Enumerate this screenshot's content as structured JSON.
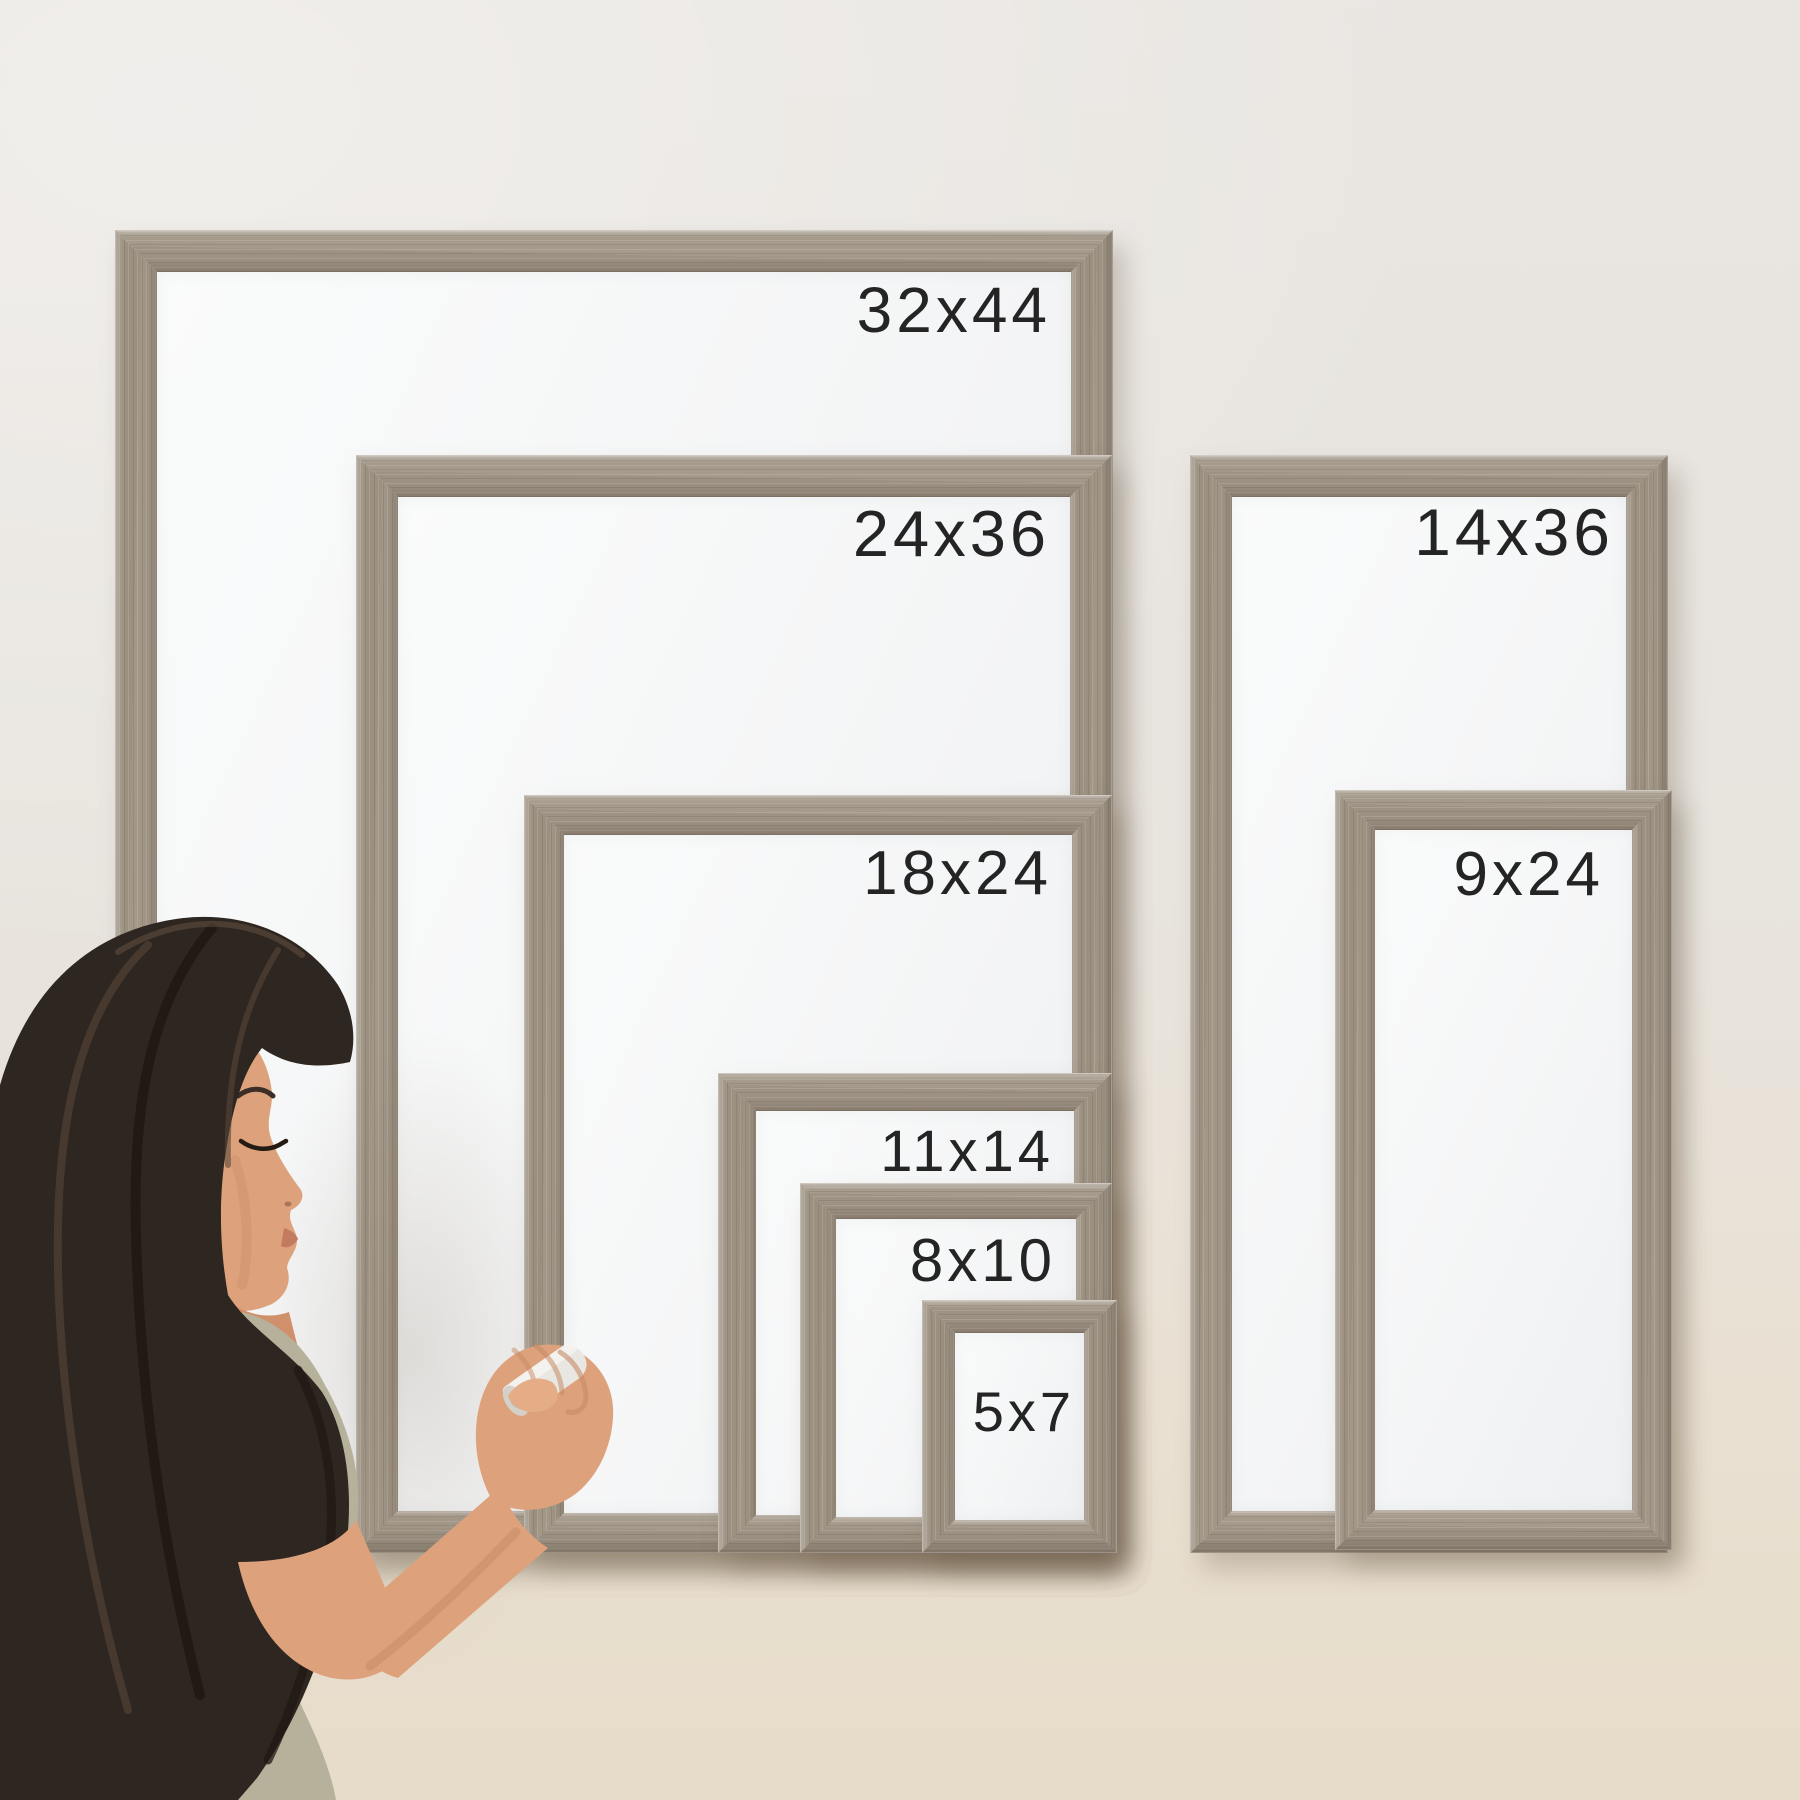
{
  "frames": [
    {
      "id": "32x44",
      "label": "32x44"
    },
    {
      "id": "24x36",
      "label": "24x36"
    },
    {
      "id": "18x24",
      "label": "18x24"
    },
    {
      "id": "11x14",
      "label": "11x14"
    },
    {
      "id": "8x10",
      "label": "8x10"
    },
    {
      "id": "5x7",
      "label": "5x7"
    },
    {
      "id": "14x36",
      "label": "14x36"
    },
    {
      "id": "9x24",
      "label": "9x24"
    }
  ],
  "palette": {
    "wall_top": "#e9e6e2",
    "wall_bottom": "#e7dcc9",
    "wood_mid": "#a59a8b",
    "wood_dark": "#7d7163",
    "wood_light": "#c3b8a9",
    "whiteboard": "#f5f6f7",
    "label_text": "#242424",
    "shirt": "#b5b19a",
    "skin": "#dda27c",
    "hair": "#2e2620",
    "marker_body": "#e9e7e2"
  },
  "figure": {
    "name": "woman-writing-on-whiteboard",
    "tool": "dry-erase-marker"
  }
}
